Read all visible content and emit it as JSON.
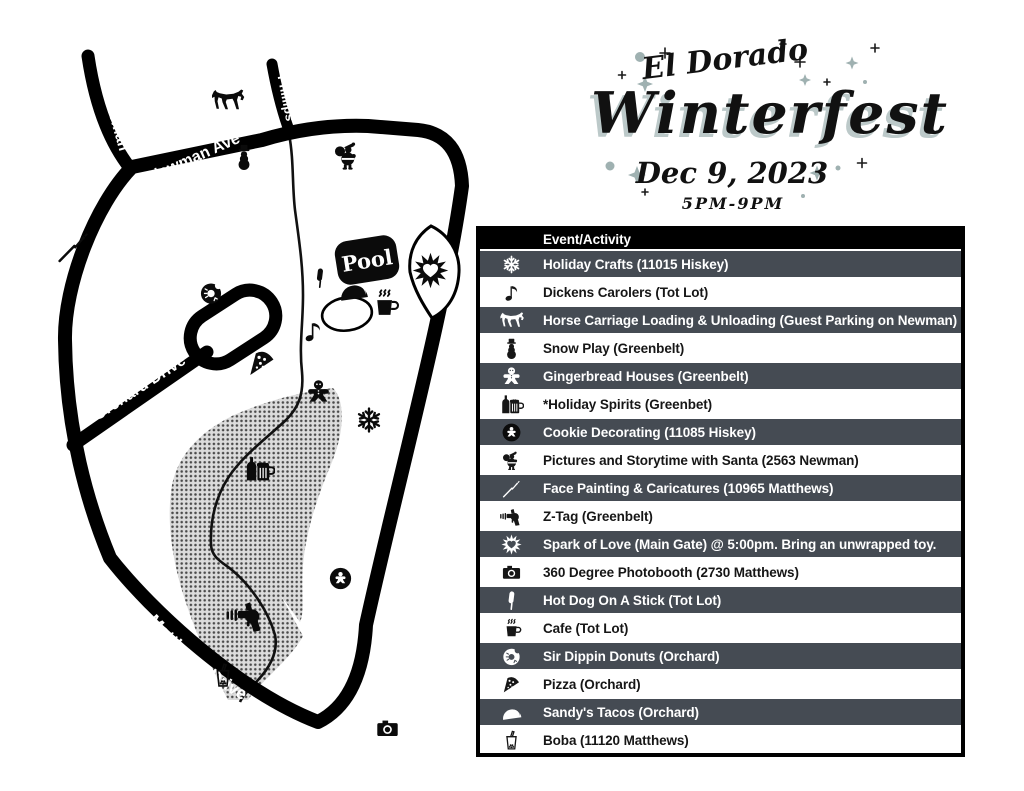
{
  "title": {
    "pre": "El Dorado",
    "main": "Winterfest",
    "date": "Dec 9, 2023",
    "time": "5PM-9PM"
  },
  "map": {
    "streets": {
      "osterman": "Osterman",
      "newman": "Newman Ave",
      "phillips": "Phillips",
      "orchard": "Orchard Drive",
      "hiskey": "Hiskey Lane",
      "matthews": "Matthews Drive"
    },
    "pool_label": "Pool",
    "icons": [
      "horse",
      "snowman",
      "santa",
      "paintbrush",
      "donut",
      "corndog",
      "taco",
      "coffee",
      "music-note",
      "pizza",
      "gingerbread",
      "snowflake",
      "spark",
      "spirits",
      "cookie",
      "raygun",
      "boba",
      "camera"
    ]
  },
  "events": {
    "header": "Event/Activity",
    "rows": [
      {
        "icon": "snowflake",
        "label": "Holiday Crafts (11015 Hiskey)"
      },
      {
        "icon": "music-note",
        "label": "Dickens Carolers (Tot Lot)"
      },
      {
        "icon": "horse",
        "label": "Horse Carriage Loading & Unloading (Guest Parking on Newman)"
      },
      {
        "icon": "snowman",
        "label": "Snow Play (Greenbelt)"
      },
      {
        "icon": "gingerbread",
        "label": "Gingerbread Houses (Greenbelt)"
      },
      {
        "icon": "spirits",
        "label": "*Holiday Spirits (Greenbet)"
      },
      {
        "icon": "cookie",
        "label": "Cookie Decorating (11085 Hiskey)"
      },
      {
        "icon": "santa",
        "label": "Pictures and Storytime with Santa (2563 Newman)"
      },
      {
        "icon": "paintbrush",
        "label": "Face Painting & Caricatures (10965 Matthews)"
      },
      {
        "icon": "raygun",
        "label": "Z-Tag (Greenbelt)"
      },
      {
        "icon": "spark",
        "label": "Spark of Love (Main Gate) @ 5:00pm. Bring an unwrapped toy."
      },
      {
        "icon": "camera",
        "label": "360 Degree Photobooth (2730 Matthews)"
      },
      {
        "icon": "corndog",
        "label": "Hot Dog On A Stick (Tot Lot)"
      },
      {
        "icon": "coffee",
        "label": "Cafe (Tot Lot)"
      },
      {
        "icon": "donut",
        "label": "Sir Dippin Donuts (Orchard)"
      },
      {
        "icon": "pizza",
        "label": "Pizza (Orchard)"
      },
      {
        "icon": "taco",
        "label": "Sandy's Tacos (Orchard)"
      },
      {
        "icon": "boba",
        "label": "Boba (11120 Matthews)"
      }
    ]
  },
  "colors": {
    "row_dark": "#454b53",
    "sparkle": "#9fb1b1",
    "title_shadow": "#bcc9c9",
    "ink": "#0b0b0b"
  }
}
